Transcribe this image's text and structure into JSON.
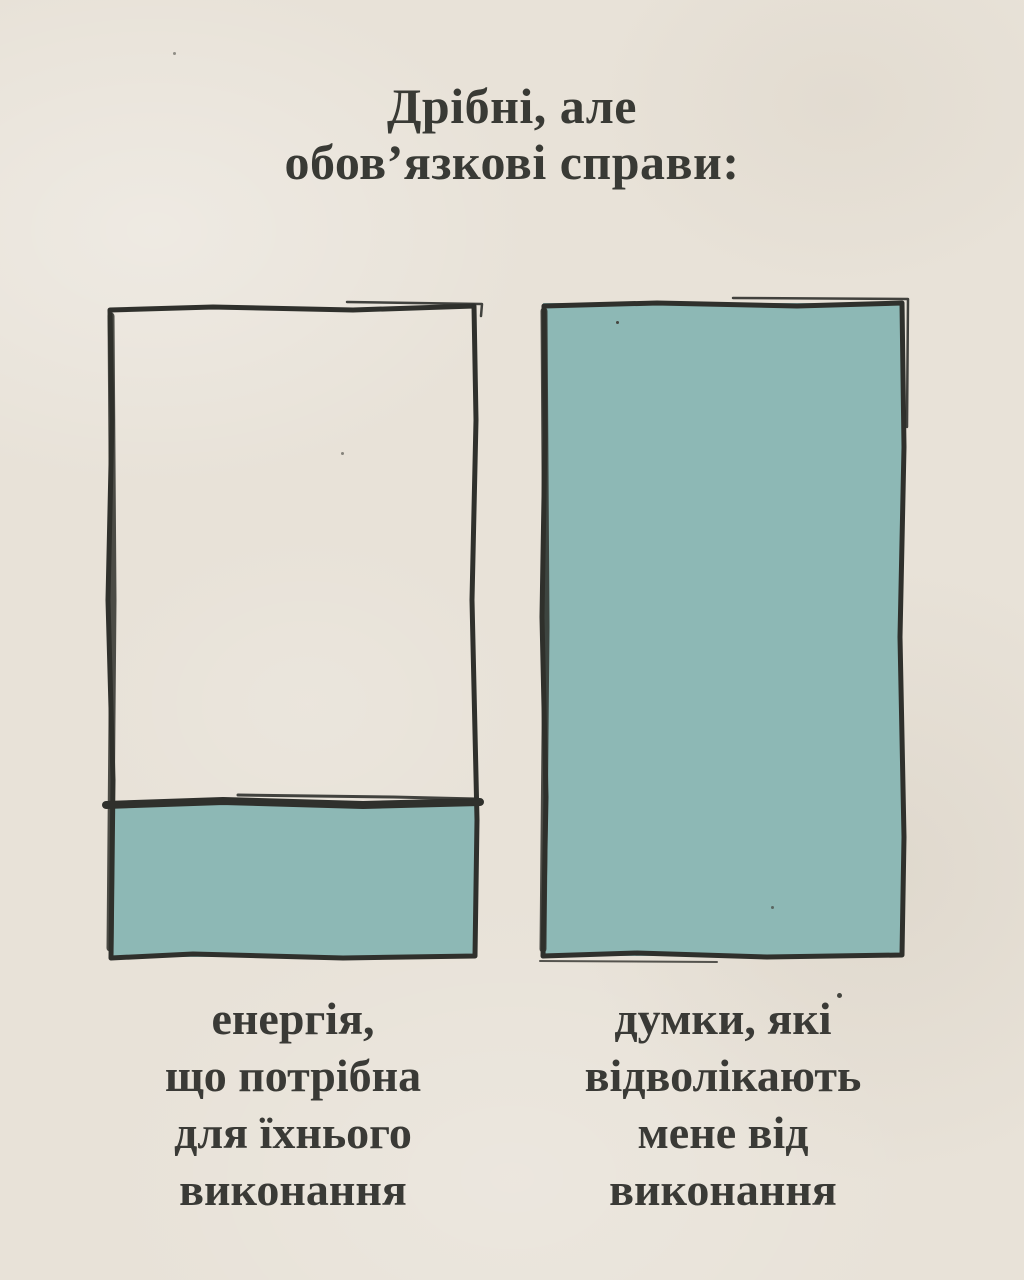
{
  "title": {
    "text": "Дрібні, але\nобов’язкові справи:"
  },
  "boxes": {
    "left": {
      "caption": "енергія,\nщо потрібна\nдля їхнього\nвиконання",
      "fill_percent": 23
    },
    "right": {
      "caption": "думки, які\nвідволікають\nмене від\nвиконання",
      "fill_percent": 100
    }
  },
  "colors": {
    "background": "#e8e2d8",
    "fill_teal": "#8db8b5",
    "ink": "#2f302c",
    "text": "#3a3a36"
  },
  "chart_data": {
    "type": "bar",
    "title": "Дрібні, але обов’язкові справи:",
    "categories": [
      "енергія, що потрібна для їхнього виконання",
      "думки, які відволікають мене від виконання"
    ],
    "values": [
      23,
      100
    ],
    "xlabel": "",
    "ylabel": "",
    "ylim": [
      0,
      100
    ],
    "legend": "none",
    "grid": false,
    "style": "two hand-drawn container rectangles; fill level (teal) represents value"
  }
}
